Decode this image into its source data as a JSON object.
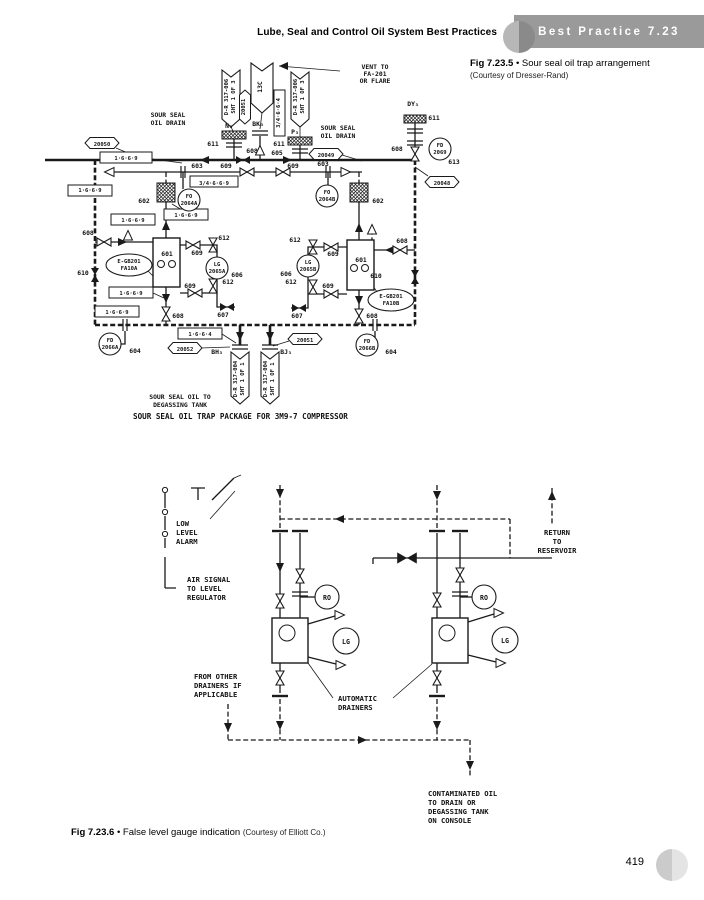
{
  "page_number": "419",
  "header": {
    "title": "Lube, Seal and Control Oil System Best Practices",
    "badge": "Best Practice 7.23"
  },
  "fig1": {
    "label": "Fig 7.23.5",
    "bullet": "•",
    "caption": "Sour seal oil trap arrangement",
    "courtesy": "(Courtesy of Dresser-Rand)",
    "texts": [
      {
        "t": "VENT TO",
        "x": 345,
        "y": 14
      },
      {
        "t": "FA-201",
        "x": 345,
        "y": 21
      },
      {
        "t": "OR FLARE",
        "x": 345,
        "y": 28
      },
      {
        "t": "D-R 317-006",
        "x": 198,
        "y": 42,
        "rot": 1,
        "cls": "s"
      },
      {
        "t": "SHT 1 OF 3",
        "x": 205,
        "y": 42,
        "rot": 1,
        "cls": "s"
      },
      {
        "t": "13C",
        "x": 232,
        "y": 32,
        "rot": 1
      },
      {
        "t": "20051",
        "x": 215,
        "y": 52,
        "rot": 1,
        "cls": "s"
      },
      {
        "t": "D-R 317-006",
        "x": 267,
        "y": 42,
        "rot": 1,
        "cls": "s"
      },
      {
        "t": "SHT 1 OF 3",
        "x": 274,
        "y": 42,
        "rot": 1,
        "cls": "s"
      },
      {
        "t": "BK₃",
        "x": 228,
        "y": 71
      },
      {
        "t": "3/4·6·6·4",
        "x": 250,
        "y": 58,
        "rot": 1,
        "cls": "s"
      },
      {
        "t": "SOUR SEAL",
        "x": 138,
        "y": 62
      },
      {
        "t": "OIL DRAIN",
        "x": 138,
        "y": 70
      },
      {
        "t": "N₃",
        "x": 199,
        "y": 73
      },
      {
        "t": "SOUR SEAL",
        "x": 308,
        "y": 75
      },
      {
        "t": "OIL DRAIN",
        "x": 308,
        "y": 83
      },
      {
        "t": "P₃",
        "x": 265,
        "y": 79
      },
      {
        "t": "611",
        "x": 183,
        "y": 91
      },
      {
        "t": "611",
        "x": 249,
        "y": 91
      },
      {
        "t": "20050",
        "x": 72,
        "y": 91,
        "cls": "s"
      },
      {
        "t": "1·6·6·9",
        "x": 96,
        "y": 105,
        "cls": "s"
      },
      {
        "t": "608",
        "x": 222,
        "y": 98
      },
      {
        "t": "605",
        "x": 247,
        "y": 100
      },
      {
        "t": "20049",
        "x": 296,
        "y": 102,
        "cls": "s"
      },
      {
        "t": "DY₃",
        "x": 383,
        "y": 51
      },
      {
        "t": "611",
        "x": 404,
        "y": 65
      },
      {
        "t": "608",
        "x": 367,
        "y": 96
      },
      {
        "t": "FD",
        "x": 410,
        "y": 92,
        "cls": "s"
      },
      {
        "t": "2069",
        "x": 410,
        "y": 99,
        "cls": "s"
      },
      {
        "t": "613",
        "x": 424,
        "y": 109
      },
      {
        "t": "20048",
        "x": 412,
        "y": 130,
        "cls": "s"
      },
      {
        "t": "603",
        "x": 167,
        "y": 113
      },
      {
        "t": "609",
        "x": 196,
        "y": 113
      },
      {
        "t": "3/4·6·6·9",
        "x": 184,
        "y": 130,
        "cls": "s"
      },
      {
        "t": "FO",
        "x": 159,
        "y": 143,
        "cls": "s"
      },
      {
        "t": "2064A",
        "x": 159,
        "y": 150,
        "cls": "s"
      },
      {
        "t": "602",
        "x": 114,
        "y": 148
      },
      {
        "t": "1·6·6·9",
        "x": 60,
        "y": 137,
        "cls": "s"
      },
      {
        "t": "609",
        "x": 263,
        "y": 113
      },
      {
        "t": "603",
        "x": 293,
        "y": 111
      },
      {
        "t": "FO",
        "x": 297,
        "y": 139,
        "cls": "s"
      },
      {
        "t": "2064B",
        "x": 297,
        "y": 146,
        "cls": "s"
      },
      {
        "t": "602",
        "x": 348,
        "y": 148
      },
      {
        "t": "1·6·6·9",
        "x": 156,
        "y": 162,
        "cls": "s"
      },
      {
        "t": "1·6·6·9",
        "x": 103,
        "y": 167,
        "cls": "s"
      },
      {
        "t": "608",
        "x": 58,
        "y": 180
      },
      {
        "t": "601",
        "x": 137,
        "y": 201
      },
      {
        "t": "E-GB201",
        "x": 99,
        "y": 208,
        "cls": "s"
      },
      {
        "t": "FA10A",
        "x": 99,
        "y": 215,
        "cls": "s"
      },
      {
        "t": "612",
        "x": 194,
        "y": 185
      },
      {
        "t": "609",
        "x": 167,
        "y": 200
      },
      {
        "t": "LG",
        "x": 187,
        "y": 211,
        "cls": "s"
      },
      {
        "t": "2065A",
        "x": 187,
        "y": 218,
        "cls": "s"
      },
      {
        "t": "606",
        "x": 207,
        "y": 222
      },
      {
        "t": "609",
        "x": 160,
        "y": 233
      },
      {
        "t": "612",
        "x": 198,
        "y": 229
      },
      {
        "t": "607",
        "x": 193,
        "y": 262
      },
      {
        "t": "610",
        "x": 53,
        "y": 220
      },
      {
        "t": "1·6·6·9",
        "x": 101,
        "y": 240,
        "cls": "s"
      },
      {
        "t": "1·6·6·9",
        "x": 87,
        "y": 259,
        "cls": "s"
      },
      {
        "t": "608",
        "x": 148,
        "y": 263
      },
      {
        "t": "FD",
        "x": 80,
        "y": 287,
        "cls": "s"
      },
      {
        "t": "2066A",
        "x": 80,
        "y": 294,
        "cls": "s"
      },
      {
        "t": "604",
        "x": 105,
        "y": 298
      },
      {
        "t": "1·6·6·4",
        "x": 170,
        "y": 281,
        "cls": "s"
      },
      {
        "t": "20052",
        "x": 155,
        "y": 296,
        "cls": "s"
      },
      {
        "t": "BH₃",
        "x": 187,
        "y": 299
      },
      {
        "t": "D-R 317-004",
        "x": 207,
        "y": 324,
        "rot": 1,
        "cls": "s"
      },
      {
        "t": "SHT 1 OF 1",
        "x": 214,
        "y": 324,
        "rot": 1,
        "cls": "s"
      },
      {
        "t": "D-R 317-004",
        "x": 237,
        "y": 324,
        "rot": 1,
        "cls": "s"
      },
      {
        "t": "SHT 1 OF 1",
        "x": 244,
        "y": 324,
        "rot": 1,
        "cls": "s"
      },
      {
        "t": "BJ₃",
        "x": 256,
        "y": 299
      },
      {
        "t": "20051",
        "x": 275,
        "y": 287,
        "cls": "s"
      },
      {
        "t": "612",
        "x": 265,
        "y": 187
      },
      {
        "t": "609",
        "x": 303,
        "y": 201
      },
      {
        "t": "LG",
        "x": 278,
        "y": 209,
        "cls": "s"
      },
      {
        "t": "2065B",
        "x": 278,
        "y": 216,
        "cls": "s"
      },
      {
        "t": "606",
        "x": 256,
        "y": 221
      },
      {
        "t": "612",
        "x": 261,
        "y": 229
      },
      {
        "t": "609",
        "x": 298,
        "y": 233
      },
      {
        "t": "607",
        "x": 267,
        "y": 263
      },
      {
        "t": "608",
        "x": 372,
        "y": 188
      },
      {
        "t": "601",
        "x": 331,
        "y": 207
      },
      {
        "t": "E-GB201",
        "x": 361,
        "y": 243,
        "cls": "s"
      },
      {
        "t": "FA10B",
        "x": 361,
        "y": 250,
        "cls": "s"
      },
      {
        "t": "610",
        "x": 346,
        "y": 223
      },
      {
        "t": "608",
        "x": 342,
        "y": 263
      },
      {
        "t": "FD",
        "x": 337,
        "y": 288,
        "cls": "s"
      },
      {
        "t": "2066B",
        "x": 337,
        "y": 295,
        "cls": "s"
      },
      {
        "t": "604",
        "x": 361,
        "y": 299
      },
      {
        "t": "SOUR SEAL OIL TO",
        "x": 150,
        "y": 344
      },
      {
        "t": "DEGASSING TANK",
        "x": 150,
        "y": 352
      },
      {
        "t": "SOUR SEAL OIL TRAP PACKAGE FOR 3M9-7 COMPRESSOR",
        "x": 103,
        "y": 364,
        "a": "s",
        "cls": "b"
      }
    ]
  },
  "fig2": {
    "label": "Fig 7.23.6",
    "bullet": "•",
    "caption": "False level gauge indication",
    "courtesy": "(Courtesy of Elliott Co.)",
    "texts": [
      {
        "t": "LOW",
        "x": 46,
        "y": 66,
        "a": "s"
      },
      {
        "t": "LEVEL",
        "x": 46,
        "y": 75,
        "a": "s"
      },
      {
        "t": "ALARM",
        "x": 46,
        "y": 84,
        "a": "s"
      },
      {
        "t": "AIR SIGNAL",
        "x": 57,
        "y": 122,
        "a": "s"
      },
      {
        "t": "TO LEVEL",
        "x": 57,
        "y": 131,
        "a": "s"
      },
      {
        "t": "REGULATOR",
        "x": 57,
        "y": 140,
        "a": "s"
      },
      {
        "t": "RO",
        "x": 197,
        "y": 140,
        "cls": "i"
      },
      {
        "t": "RO",
        "x": 354,
        "y": 140,
        "cls": "i"
      },
      {
        "t": "LG",
        "x": 216,
        "y": 184,
        "cls": "i"
      },
      {
        "t": "LG",
        "x": 375,
        "y": 183,
        "cls": "i"
      },
      {
        "t": "RETURN",
        "x": 427,
        "y": 75
      },
      {
        "t": "TO",
        "x": 427,
        "y": 84
      },
      {
        "t": "RESERVOIR",
        "x": 427,
        "y": 93
      },
      {
        "t": "FROM OTHER",
        "x": 64,
        "y": 219,
        "a": "s"
      },
      {
        "t": "DRAINERS IF",
        "x": 64,
        "y": 228,
        "a": "s"
      },
      {
        "t": "APPLICABLE",
        "x": 64,
        "y": 237,
        "a": "s"
      },
      {
        "t": "AUTOMATIC",
        "x": 208,
        "y": 241,
        "a": "s"
      },
      {
        "t": "DRAINERS",
        "x": 208,
        "y": 250,
        "a": "s"
      },
      {
        "t": "CONTAMINATED OIL",
        "x": 298,
        "y": 336,
        "a": "s"
      },
      {
        "t": "TO DRAIN OR",
        "x": 298,
        "y": 345,
        "a": "s"
      },
      {
        "t": "DEGASSING TANK",
        "x": 298,
        "y": 354,
        "a": "s"
      },
      {
        "t": "ON CONSOLE",
        "x": 298,
        "y": 363,
        "a": "s"
      }
    ]
  }
}
